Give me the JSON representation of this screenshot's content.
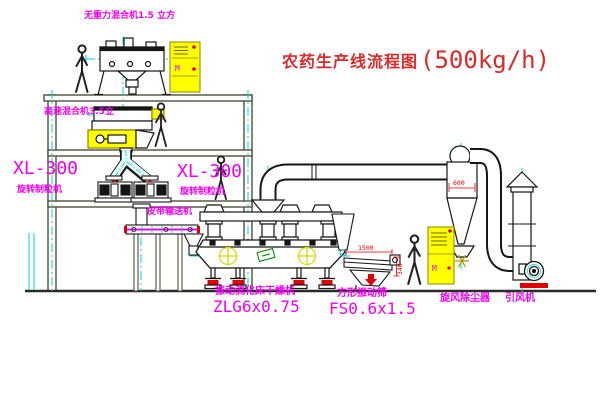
{
  "title": {
    "name": "农药生产线流程图",
    "capacity": "(500kg/h)"
  },
  "equipment_labels": {
    "gravity_mixer": "无重力混合机1.5 立方",
    "high_speed_mixer": "高速混合机3.5立",
    "granulator_left_model": "XL-300",
    "granulator_left_name": "旋转制粒机",
    "granulator_center_model": "XL-300",
    "granulator_center_name": "旋转制粒机",
    "belt_conveyor": "皮带输送机",
    "fluid_bed_dryer_name": "振动流化床干燥机",
    "fluid_bed_dryer_model": "ZLG6x0.75",
    "square_sieve_name": "方形振动筛",
    "square_sieve_model": "FS0.6x1.5",
    "cyclone": "旋风除尘器",
    "induced_draft_fan": "引风机"
  },
  "dimensions": {
    "cyclone_inlet": "600",
    "sieve_length": "1500",
    "sieve_height": "340"
  },
  "control_cabinets": {
    "cabinet1_symbol": "M",
    "cabinet2_symbol": "M"
  },
  "colors": {
    "label_magenta": "#f000f0",
    "title_red": "#d92b2b",
    "centerline_cyan": "#00d4d4",
    "cabinet_yellow": "#ffff00",
    "accent_red": "#e00000",
    "accent_green": "#0a8a0a",
    "structure_olive": "#50503a",
    "line_black": "#1a1a1a"
  }
}
